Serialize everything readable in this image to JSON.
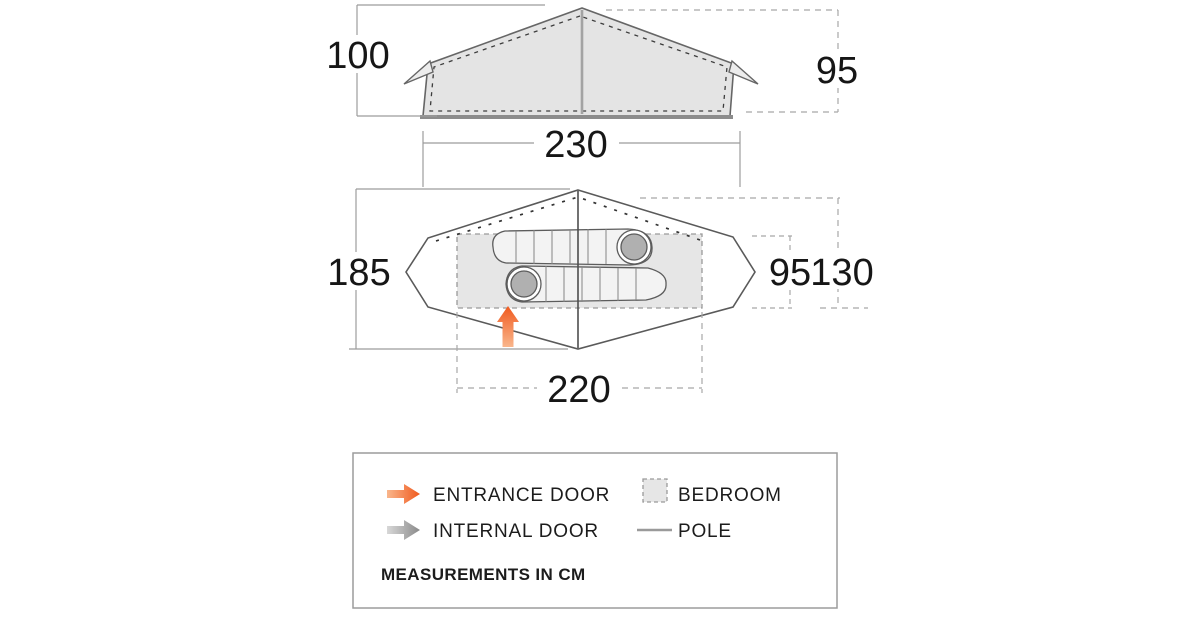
{
  "views": {
    "elevation": {
      "label_pole_height": "100",
      "label_inner_height": "95",
      "label_base_width": "230"
    },
    "plan": {
      "label_total_depth": "185",
      "label_bedroom_length": "220",
      "label_bedroom_depth": "95",
      "label_fly_depth": "130"
    }
  },
  "legend": {
    "items": [
      {
        "id": "entrance-door",
        "label": "ENTRANCE DOOR"
      },
      {
        "id": "bedroom",
        "label": "BEDROOM"
      },
      {
        "id": "internal-door",
        "label": "INTERNAL DOOR"
      },
      {
        "id": "pole",
        "label": "POLE"
      }
    ],
    "note": "MEASUREMENTS IN CM"
  },
  "colors": {
    "accent_orange": "#f05a1e",
    "accent_orange_light": "#f9b68c",
    "outline_dark": "#5f5f5f",
    "dim_line_gray": "#9c9c9c",
    "fill_light_gray": "#e4e4e4",
    "hood_gray": "#b0b0b0",
    "text_dark": "#161616"
  }
}
